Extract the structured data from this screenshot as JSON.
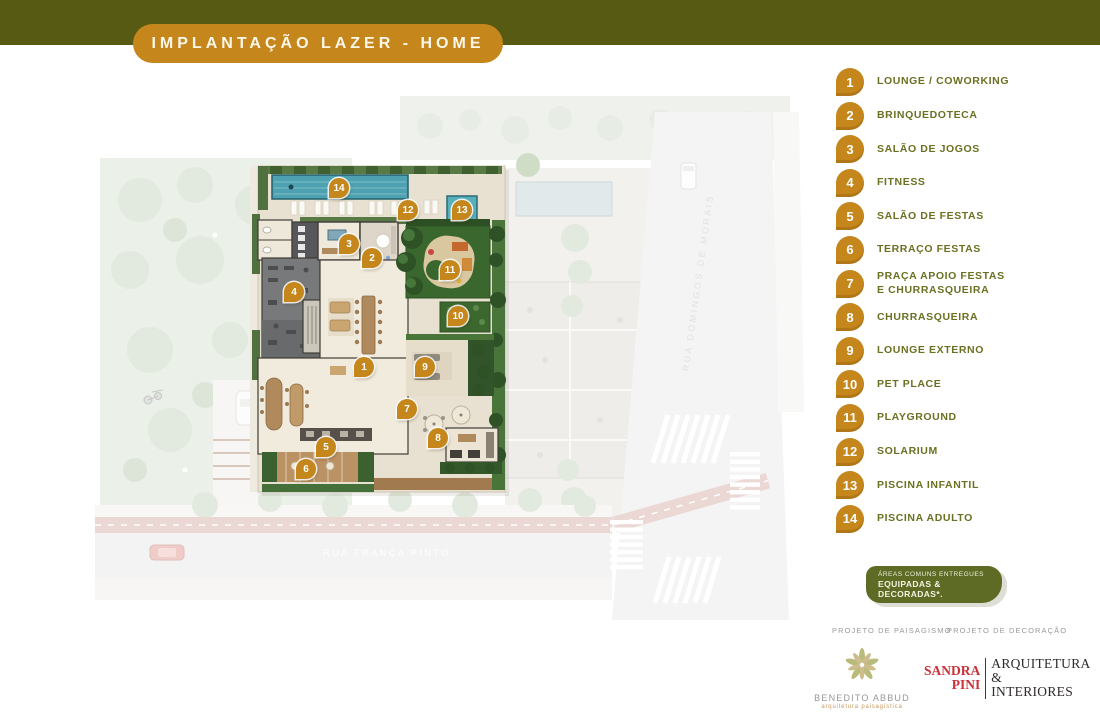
{
  "header": {
    "title": "IMPLANTAÇÃO LAZER - HOME",
    "bar_color": "#575a13",
    "banner_color": "#c5861c"
  },
  "legend": {
    "marker_color": "#c5861c",
    "text_color": "#6c7022",
    "items": [
      {
        "num": "1",
        "label": "LOUNGE / COWORKING"
      },
      {
        "num": "2",
        "label": "BRINQUEDOTECA"
      },
      {
        "num": "3",
        "label": "SALÃO DE JOGOS"
      },
      {
        "num": "4",
        "label": "FITNESS"
      },
      {
        "num": "5",
        "label": "SALÃO DE FESTAS"
      },
      {
        "num": "6",
        "label": "TERRAÇO FESTAS"
      },
      {
        "num": "7",
        "label": "PRAÇA APOIO FESTAS",
        "label2": "E CHURRASQUEIRA"
      },
      {
        "num": "8",
        "label": "CHURRASQUEIRA"
      },
      {
        "num": "9",
        "label": "LOUNGE EXTERNO"
      },
      {
        "num": "10",
        "label": "PET PLACE"
      },
      {
        "num": "11",
        "label": "PLAYGROUND"
      },
      {
        "num": "12",
        "label": "SOLARIUM"
      },
      {
        "num": "13",
        "label": "PISCINA INFANTIL"
      },
      {
        "num": "14",
        "label": "PISCINA ADULTO"
      }
    ]
  },
  "plan": {
    "street_horizontal": "RUA FRANÇA PINTO",
    "street_vertical": "RUA DOMINGOS DE MORAIS",
    "pool_color": "#4da1b0",
    "markers": [
      "1",
      "2",
      "3",
      "4",
      "5",
      "6",
      "7",
      "8",
      "9",
      "10",
      "11",
      "12",
      "13",
      "14"
    ]
  },
  "badge": {
    "line1": "ÁREAS COMUNS ENTREGUES",
    "line2": "EQUIPADAS & DECORADAS*.",
    "color": "#5d6b24"
  },
  "footer": {
    "left_heading": "PROJETO DE PAISAGISMO",
    "right_heading": "PROJETO DE DECORAÇÃO",
    "landscape_name": "BENEDITO ABBUD",
    "landscape_sub": "arquitetura paisagística",
    "decor_name_line1": "SANDRA",
    "decor_name_line2": "PINI",
    "decor_desc_line1": "ARQUITETURA &",
    "decor_desc_line2": "INTERIORES",
    "decor_red": "#cb3038"
  }
}
